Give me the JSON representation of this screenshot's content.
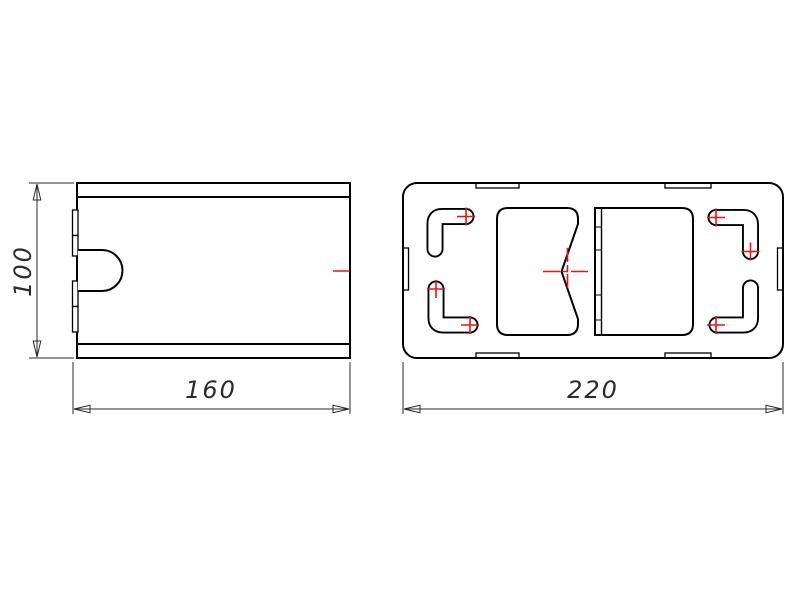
{
  "drawing": {
    "title": "sheet-metal-part-two-view-drawing",
    "colors": {
      "background": "#ffffff",
      "outline": "#000000",
      "dimension": "#2a2a2a",
      "centerline_red": "#ee1111"
    },
    "front_view": {
      "height_dim": "100",
      "width_dim": "160"
    },
    "top_view": {
      "width_dim": "220"
    }
  }
}
